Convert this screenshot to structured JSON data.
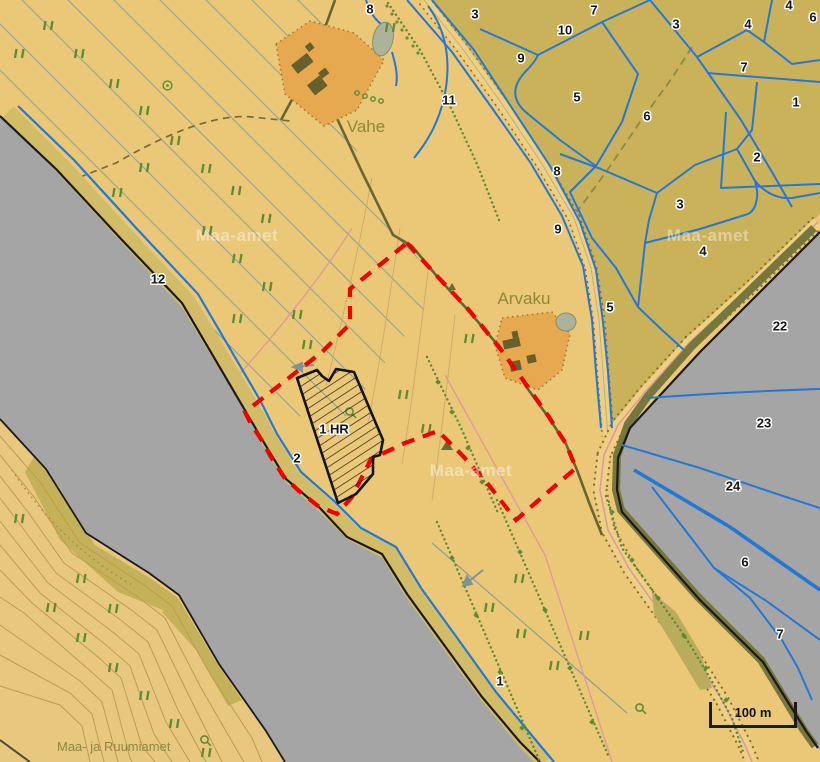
{
  "map": {
    "watermark": "Maa-amet",
    "attribution": "Maa- ja Ruumiamet",
    "scale_bar": {
      "label": "100 m"
    },
    "place_labels": [
      {
        "text": "Vahe",
        "x": 366,
        "y": 127
      },
      {
        "text": "Arvaku",
        "x": 524,
        "y": 299
      }
    ],
    "selected_unit": {
      "text": "1 HR",
      "x": 334,
      "y": 430
    },
    "parcel_labels": [
      {
        "text": "8",
        "x": 370,
        "y": 10
      },
      {
        "text": "3",
        "x": 475,
        "y": 15
      },
      {
        "text": "10",
        "x": 565,
        "y": 31
      },
      {
        "text": "7",
        "x": 594,
        "y": 11
      },
      {
        "text": "3",
        "x": 676,
        "y": 25
      },
      {
        "text": "4",
        "x": 748,
        "y": 25
      },
      {
        "text": "4",
        "x": 789,
        "y": 6
      },
      {
        "text": "6",
        "x": 813,
        "y": 18
      },
      {
        "text": "9",
        "x": 521,
        "y": 59
      },
      {
        "text": "7",
        "x": 744,
        "y": 68
      },
      {
        "text": "5",
        "x": 577,
        "y": 98
      },
      {
        "text": "11",
        "x": 449,
        "y": 101
      },
      {
        "text": "1",
        "x": 796,
        "y": 103
      },
      {
        "text": "6",
        "x": 647,
        "y": 117
      },
      {
        "text": "2",
        "x": 757,
        "y": 158
      },
      {
        "text": "8",
        "x": 557,
        "y": 172
      },
      {
        "text": "3",
        "x": 680,
        "y": 205
      },
      {
        "text": "9",
        "x": 558,
        "y": 230
      },
      {
        "text": "4",
        "x": 703,
        "y": 252
      },
      {
        "text": "12",
        "x": 158,
        "y": 280
      },
      {
        "text": "5",
        "x": 610,
        "y": 308
      },
      {
        "text": "22",
        "x": 780,
        "y": 327
      },
      {
        "text": "23",
        "x": 764,
        "y": 424
      },
      {
        "text": "24",
        "x": 733,
        "y": 487
      },
      {
        "text": "2",
        "x": 297,
        "y": 459
      },
      {
        "text": "6",
        "x": 745,
        "y": 563
      },
      {
        "text": "7",
        "x": 780,
        "y": 635
      },
      {
        "text": "1",
        "x": 500,
        "y": 682
      }
    ],
    "colors": {
      "land_tan": "#EAC878",
      "field_olive": "#C9B25A",
      "water_gray": "#A5A5A5",
      "boundary_blue": "#2478D4",
      "selection_red": "#EC0000",
      "farmyard_orange": "#E7A94F",
      "road_fill": "#EDD084",
      "coastline_black": "#1A1A1A",
      "symbol_green": "#5F8B35"
    }
  }
}
